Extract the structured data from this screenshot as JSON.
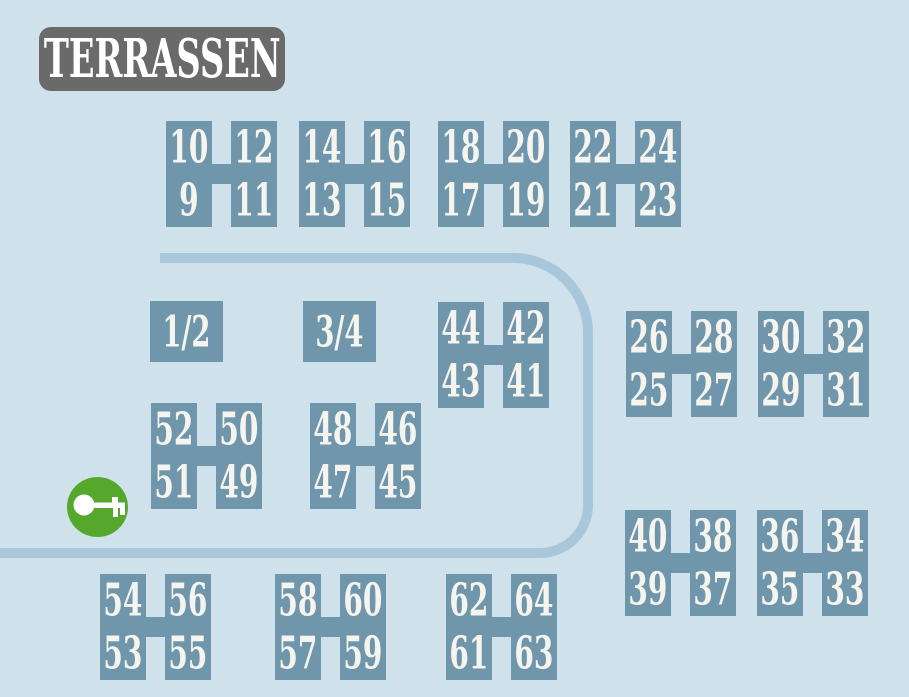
{
  "title": "TERRASSEN",
  "colors": {
    "background": "#cfe2ec",
    "terrace_block": "#6f96ab",
    "road": "#a8c7da",
    "title_background": "#6a6a6a",
    "number_text": "#f5f4ef",
    "key_circle_green": "#55a82c",
    "key_glyph": "#ffffff"
  },
  "terrace_pairs": [
    {
      "x": 166,
      "y": 121,
      "cells": [
        "10",
        "12",
        "9",
        "11"
      ]
    },
    {
      "x": 299,
      "y": 121,
      "cells": [
        "14",
        "16",
        "13",
        "15"
      ]
    },
    {
      "x": 438,
      "y": 121,
      "cells": [
        "18",
        "20",
        "17",
        "19"
      ]
    },
    {
      "x": 570,
      "y": 121,
      "cells": [
        "22",
        "24",
        "21",
        "23"
      ]
    },
    {
      "x": 438,
      "y": 302,
      "cells": [
        "44",
        "42",
        "43",
        "41"
      ]
    },
    {
      "x": 626,
      "y": 311,
      "cells": [
        "26",
        "28",
        "25",
        "27"
      ]
    },
    {
      "x": 758,
      "y": 311,
      "cells": [
        "30",
        "32",
        "29",
        "31"
      ]
    },
    {
      "x": 151,
      "y": 403,
      "cells": [
        "52",
        "50",
        "51",
        "49"
      ]
    },
    {
      "x": 310,
      "y": 403,
      "cells": [
        "48",
        "46",
        "47",
        "45"
      ]
    },
    {
      "x": 625,
      "y": 510,
      "cells": [
        "40",
        "38",
        "39",
        "37"
      ]
    },
    {
      "x": 757,
      "y": 510,
      "cells": [
        "36",
        "34",
        "35",
        "33"
      ]
    },
    {
      "x": 100,
      "y": 574,
      "cells": [
        "54",
        "56",
        "53",
        "55"
      ]
    },
    {
      "x": 275,
      "y": 574,
      "cells": [
        "58",
        "60",
        "57",
        "59"
      ]
    },
    {
      "x": 446,
      "y": 574,
      "cells": [
        "62",
        "64",
        "61",
        "63"
      ]
    }
  ],
  "combined_terraces": [
    {
      "x": 150,
      "y": 301,
      "label": "1/2"
    },
    {
      "x": 303,
      "y": 301,
      "label": "3/4"
    }
  ],
  "key_marker": {
    "icon": "key-icon"
  }
}
